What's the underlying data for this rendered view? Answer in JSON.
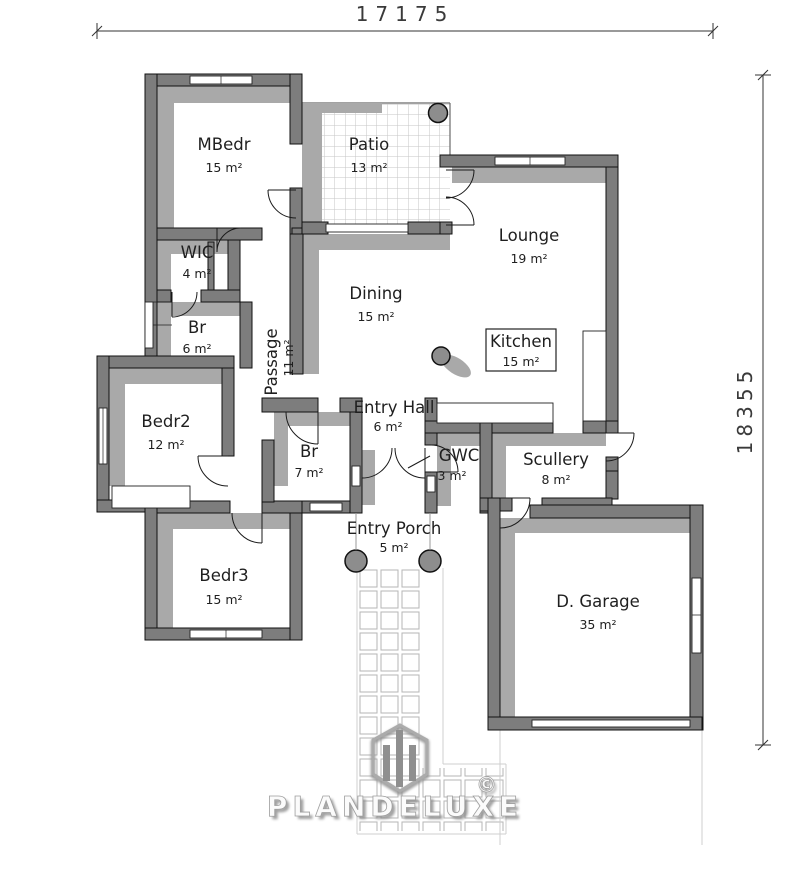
{
  "drawing": {
    "type": "residential floor plan",
    "dimensions": {
      "top": "17175",
      "right": "18355"
    },
    "rooms": [
      {
        "name": "MBedr",
        "area": "15 m²"
      },
      {
        "name": "Patio",
        "area": "13 m²"
      },
      {
        "name": "Lounge",
        "area": "19 m²"
      },
      {
        "name": "WIC",
        "area": "4 m²"
      },
      {
        "name": "Br",
        "area": "6 m²"
      },
      {
        "name": "Dining",
        "area": "15 m²"
      },
      {
        "name": "Kitchen",
        "area": "15 m²"
      },
      {
        "name": "Passage",
        "area": "11 m²"
      },
      {
        "name": "Bedr2",
        "area": "12 m²"
      },
      {
        "name": "Entry Hall",
        "area": "6 m²"
      },
      {
        "name": "Br",
        "area": "7 m²"
      },
      {
        "name": "GWC",
        "area": "3 m²"
      },
      {
        "name": "Scullery",
        "area": "8 m²"
      },
      {
        "name": "Entry Porch",
        "area": "5 m²"
      },
      {
        "name": "Bedr3",
        "area": "15 m²"
      },
      {
        "name": "D. Garage",
        "area": "35 m²"
      }
    ],
    "watermark": {
      "brand": "PLANDELUXE",
      "copyright": "©"
    },
    "colors": {
      "wall": "#7d7d7d",
      "shadow": "#a9a9a9",
      "line": "#1a1a1a",
      "tile_line": "#c6c6c6",
      "background": "#ffffff"
    }
  }
}
